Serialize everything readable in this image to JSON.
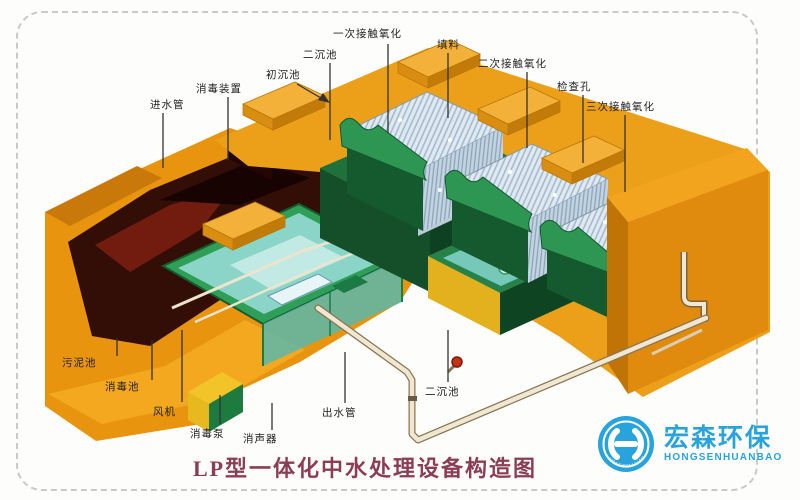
{
  "title": "LP型一体化中水处理设备构造图",
  "logo": {
    "name_cn": "宏森环保",
    "name_en": "HONGSENHUANBAO",
    "ring_text": "HONGSENHUANBAO",
    "color": "#29a3dc"
  },
  "labels": {
    "inlet_pipe": "进水管",
    "disinfection_device": "消毒装置",
    "primary_sedimentation_tank": "初沉池",
    "secondary_sedimentation_tank_top": "二沉池",
    "primary_contact_oxidation": "一次接触氧化",
    "packing": "填料",
    "secondary_contact_oxidation": "二次接触氧化",
    "inspection_hole": "检查孔",
    "tertiary_contact_oxidation": "三次接触氧化",
    "sludge_tank": "污泥池",
    "disinfection_tank": "消毒池",
    "blower": "风机",
    "disinfection_pump": "消毒泵",
    "silencer": "消声器",
    "outlet_pipe": "出水管",
    "secondary_sedimentation_tank_bottom": "二沉池"
  },
  "colors": {
    "shell_orange": "#e8940f",
    "deck_orange": "#eca01a",
    "shadow_orange": "#c07406",
    "tank_green": "#1e713a",
    "rim_green": "#2f9e57",
    "pool_teal": "#8fd8ce",
    "cavity_maroon": "#330e07",
    "packing_fill": "#dfe9f2",
    "pipe_cream": "#efe7d2",
    "title_color": "#8c3d55",
    "logo_blue": "#29a3dc",
    "border_gray": "#c9c9c9"
  }
}
